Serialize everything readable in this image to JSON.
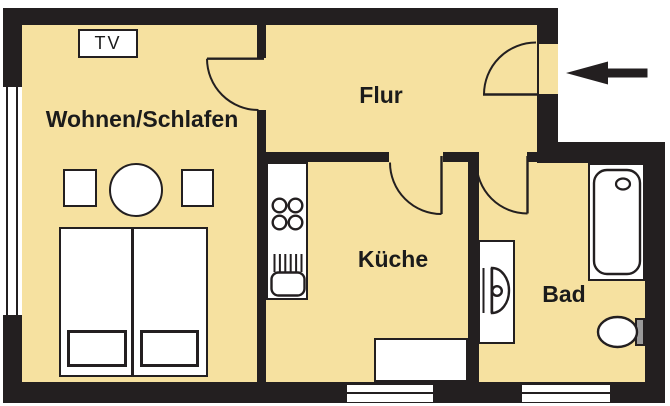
{
  "rooms": {
    "living": {
      "label": "Wohnen/Schlafen"
    },
    "hall": {
      "label": "Flur"
    },
    "kitchen": {
      "label": "Küche"
    },
    "bath": {
      "label": "Bad"
    }
  },
  "furniture": {
    "tv": "TV"
  },
  "icons": {
    "entrance_arrow": "left-arrow"
  },
  "colors": {
    "wall": "#231f20",
    "outline": "#231f20",
    "floor": "#f6e1a0",
    "cistern": "#9a9a9a",
    "page": "#ffffff",
    "text": "#1b1b1b"
  }
}
